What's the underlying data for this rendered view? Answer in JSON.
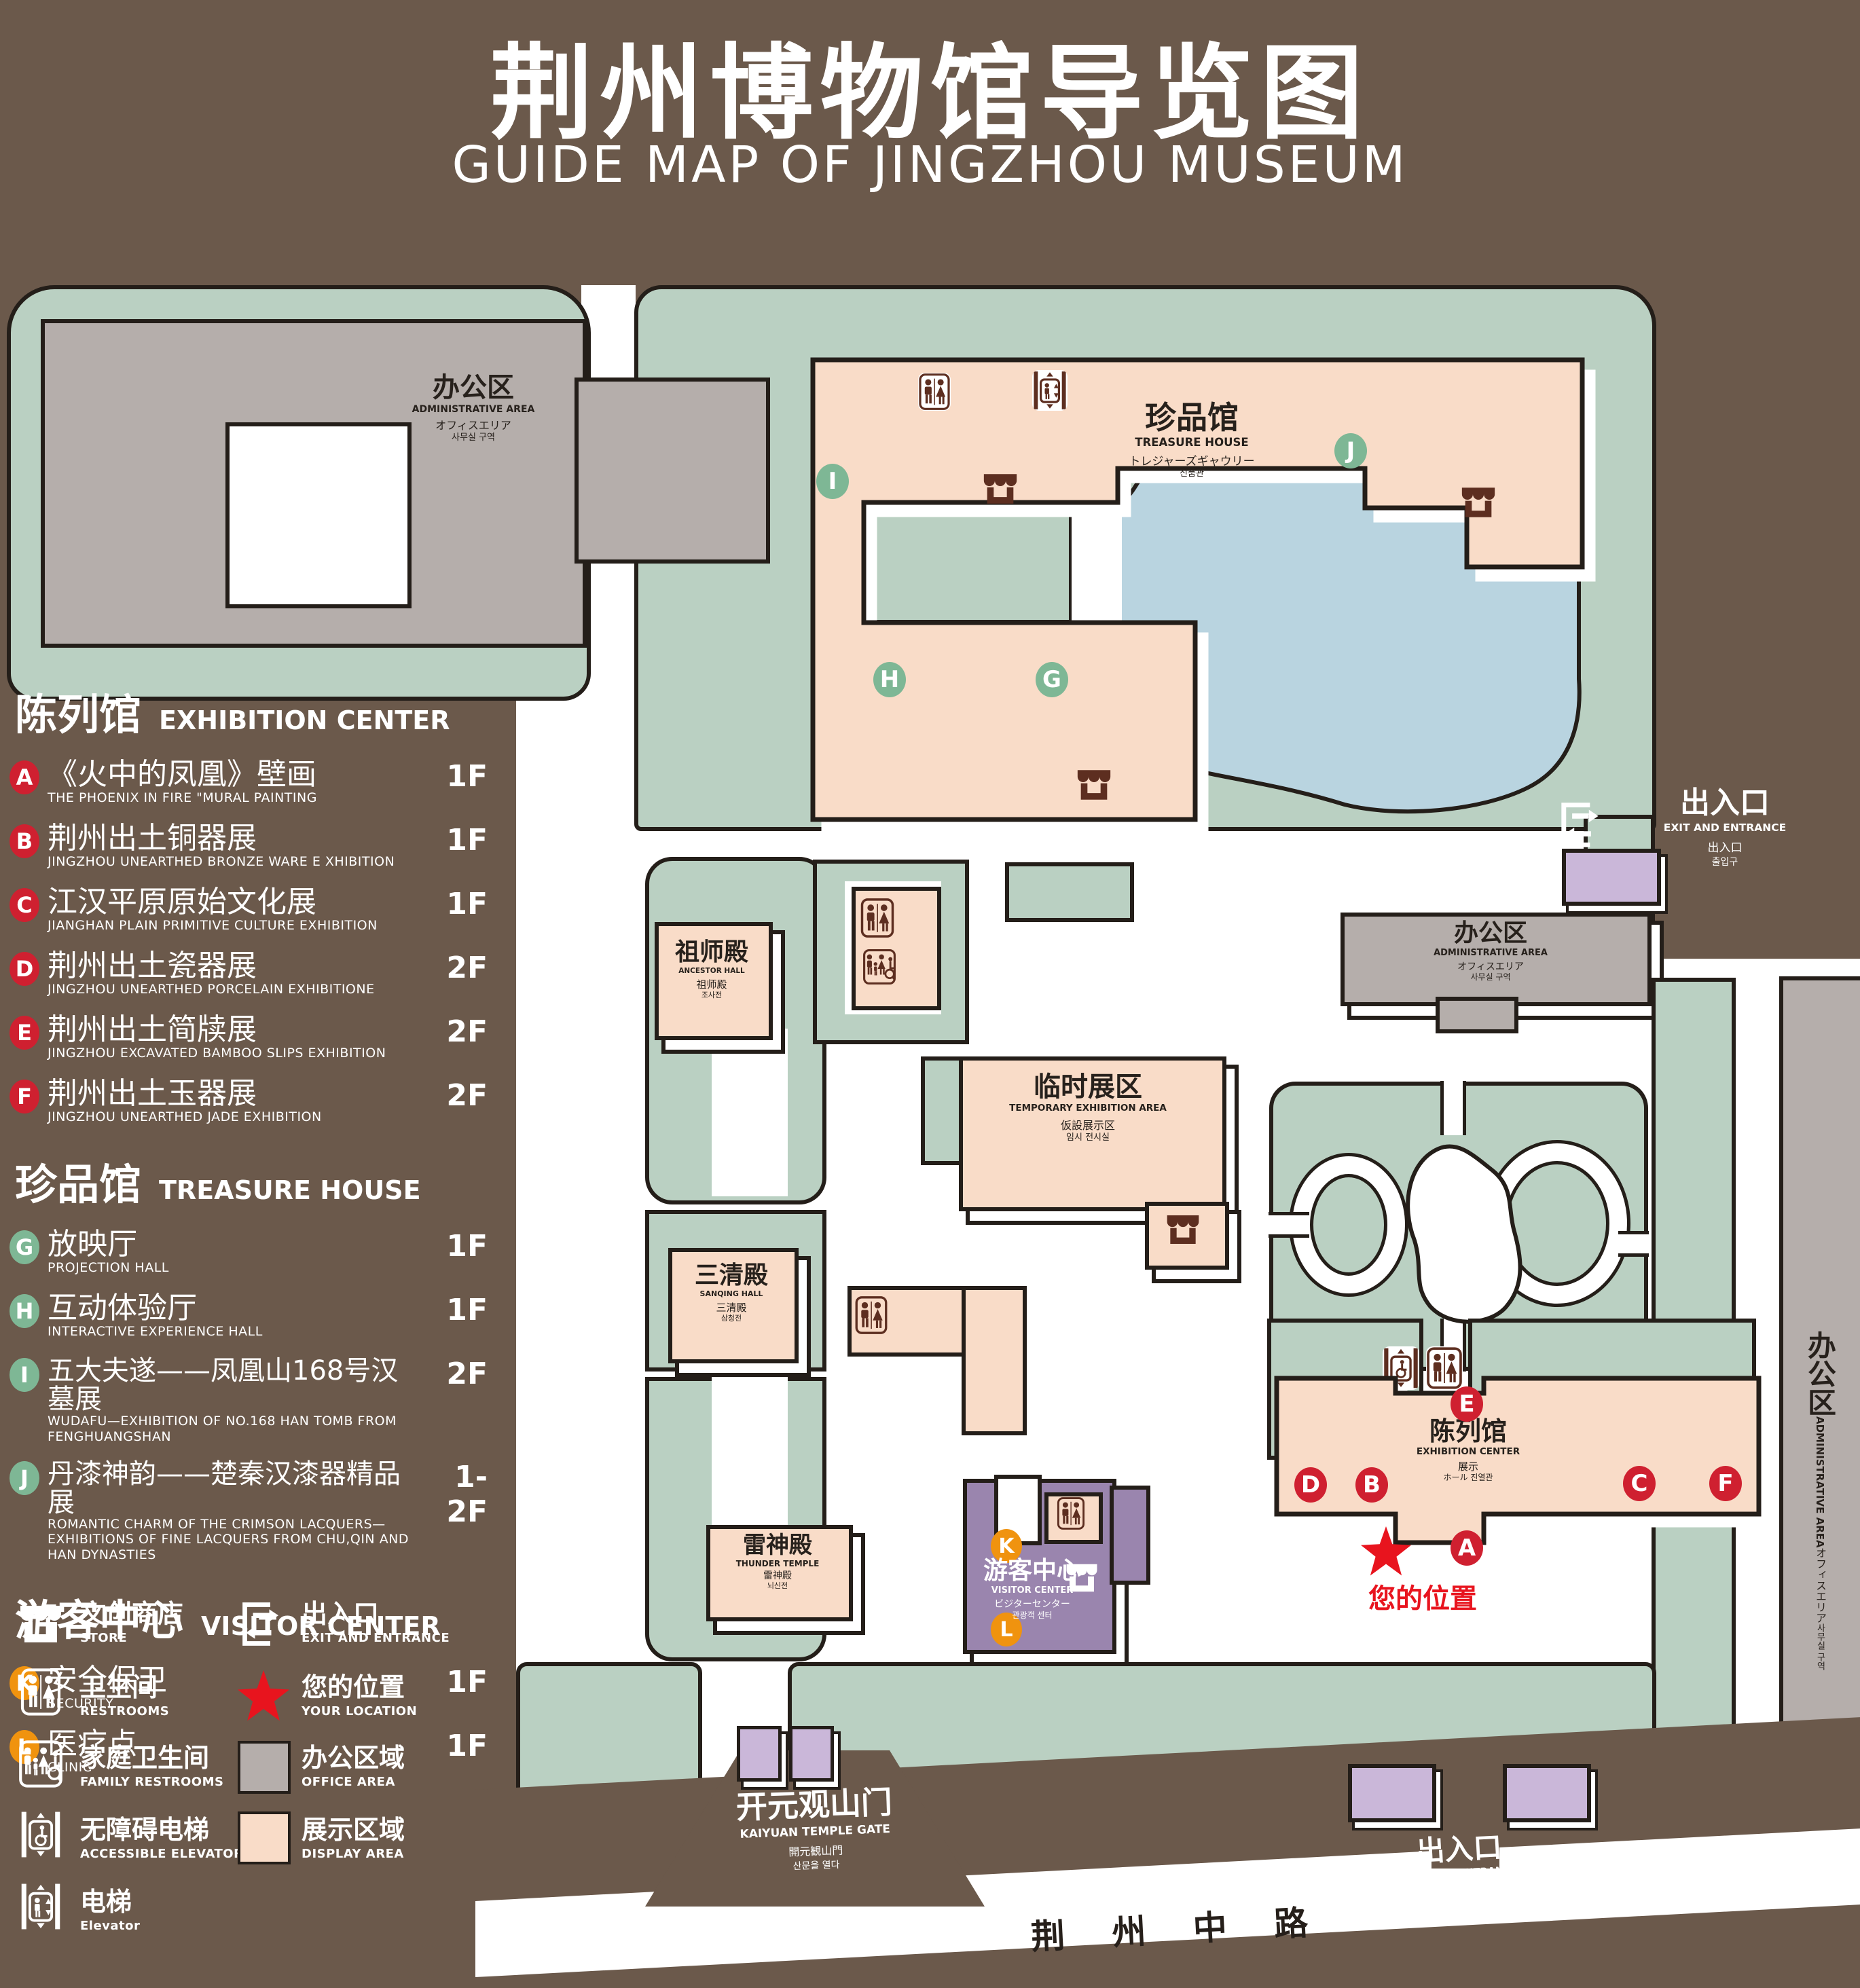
{
  "page": {
    "title_zh": "荆州博物馆导览图",
    "title_en": "GUIDE MAP OF JINGZHOU MUSEUM"
  },
  "colors": {
    "background": "#6b594b",
    "green": "#bad0c2",
    "pink": "#f9dcc8",
    "lake": "#b9d4e0",
    "purple": "#9a85ae",
    "lavender": "#cab7d9",
    "gray": "#b5aeab",
    "badge_red": "#cf2030",
    "badge_green": "#7eb795",
    "badge_orange": "#f0930f",
    "star_red": "#e8141e",
    "icon_brown": "#5d2e20",
    "outline": "#241e19"
  },
  "legend": {
    "sections": [
      {
        "title_zh": "陈列馆",
        "title_en": "EXHIBITION CENTER",
        "items": [
          {
            "id": "A",
            "zh": "《火中的凤凰》壁画",
            "en": "THE PHOENIX IN FIRE \"MURAL PAINTING",
            "floor": "1F"
          },
          {
            "id": "B",
            "zh": "荆州出土铜器展",
            "en": "JINGZHOU UNEARTHED BRONZE WARE E XHIBITION",
            "floor": "1F"
          },
          {
            "id": "C",
            "zh": "江汉平原原始文化展",
            "en": "JIANGHAN PLAIN PRIMITIVE CULTURE EXHIBITION",
            "floor": "1F"
          },
          {
            "id": "D",
            "zh": "荆州出土瓷器展",
            "en": "JINGZHOU UNEARTHED PORCELAIN EXHIBITIONE",
            "floor": "2F"
          },
          {
            "id": "E",
            "zh": "荆州出土简牍展",
            "en": "JINGZHOU EXCAVATED BAMBOO SLIPS EXHIBITION",
            "floor": "2F"
          },
          {
            "id": "F",
            "zh": "荆州出土玉器展",
            "en": "JINGZHOU UNEARTHED JADE EXHIBITION",
            "floor": "2F"
          }
        ]
      },
      {
        "title_zh": "珍品馆",
        "title_en": "TREASURE HOUSE",
        "items": [
          {
            "id": "G",
            "zh": "放映厅",
            "en": "PROJECTION HALL",
            "floor": "1F"
          },
          {
            "id": "H",
            "zh": "互动体验厅",
            "en": "INTERACTIVE EXPERIENCE HALL",
            "floor": "1F"
          },
          {
            "id": "I",
            "zh": "五大夫遂——凤凰山168号汉墓展",
            "en": "WUDAFU—EXHIBITION OF NO.168 HAN TOMB FROM FENGHUANGSHAN",
            "floor": "2F"
          },
          {
            "id": "J",
            "zh": "丹漆神韵——楚秦汉漆器精品展",
            "en": "ROMANTIC CHARM OF THE CRIMSON LACQUERS—EXHIBITIONS OF FINE LACQUERS FROM CHU,QIN AND HAN DYNASTIES",
            "floor": "1-2F"
          }
        ]
      },
      {
        "title_zh": "游客中心",
        "title_en": "VISITOR CENTER",
        "items": [
          {
            "id": "K",
            "zh": "安全保卫",
            "en": "SECURITY",
            "floor": "1F"
          },
          {
            "id": "L",
            "zh": "医疗点",
            "en": "CLINIC",
            "floor": "1F"
          }
        ]
      }
    ],
    "symbols_left": [
      {
        "icon": "store-icon",
        "zh": "文创商店",
        "en": "STORE"
      },
      {
        "icon": "restrooms-icon",
        "zh": "卫生间",
        "en": "RESTROOMS"
      },
      {
        "icon": "family-restrooms-icon",
        "zh": "家庭卫生间",
        "en": "FAMILY RESTROOMS"
      },
      {
        "icon": "accessible-elevator-icon",
        "zh": "无障碍电梯",
        "en": "ACCESSIBLE  ELEVATOR"
      },
      {
        "icon": "elevator-icon",
        "zh": "电梯",
        "en": "Elevator"
      }
    ],
    "symbols_right": [
      {
        "icon": "exit-icon",
        "zh": "出入口",
        "en": "EXIT AND ENTRANCE"
      },
      {
        "icon": "your-location-star",
        "zh": "您的位置",
        "en": "YOUR LOCATION"
      },
      {
        "icon": "office-area-swatch",
        "zh": "办公区域",
        "en": "OFFICE AREA"
      },
      {
        "icon": "display-area-swatch",
        "zh": "展示区域",
        "en": "DISPLAY AREA"
      }
    ]
  },
  "map": {
    "admin": {
      "zh": "办公区",
      "en": "ADMINISTRATIVE AREA",
      "ja": "オフィスエリア",
      "ko": "사무실 구역"
    },
    "treasure": {
      "zh": "珍品馆",
      "en": "TREASURE HOUSE",
      "ja": "トレジャーズギャウリー",
      "ko": "진품관"
    },
    "ancestor": {
      "zh": "祖师殿",
      "en": "ANCESTOR HALL",
      "ja": "祖师殿",
      "ko": "조사전"
    },
    "temporary": {
      "zh": "临时展区",
      "en": "TEMPORARY EXHIBITION AREA",
      "ja": "仮設展示区",
      "ko": "임시 전시실"
    },
    "sanqing": {
      "zh": "三清殿",
      "en": "SANQING HALL",
      "ja": "三清殿",
      "ko": "삼청전"
    },
    "thunder": {
      "zh": "雷神殿",
      "en": "THUNDER TEMPLE",
      "ja": "雷神殿",
      "ko": "뇌신전"
    },
    "visitor": {
      "zh": "游客中心",
      "en": "VISITOR CENTER",
      "ja": "ビジターセンター",
      "ko": "관광객 센터"
    },
    "exhibition": {
      "zh": "陈列馆",
      "en": "EXHIBITION CENTER",
      "ja": "展示",
      "ko": "ホール 진열관"
    },
    "exit": {
      "zh": "出入口",
      "en": "EXIT AND ENTRANCE",
      "ja": "出入口",
      "ko": "출입구"
    },
    "gate": {
      "zh": "开元观山门",
      "en": "KAIYUAN TEMPLE GATE",
      "ja": "開元観山門",
      "ko": "산문을 열다"
    },
    "road": "荆 州 中 路",
    "your_location": "您的位置"
  }
}
